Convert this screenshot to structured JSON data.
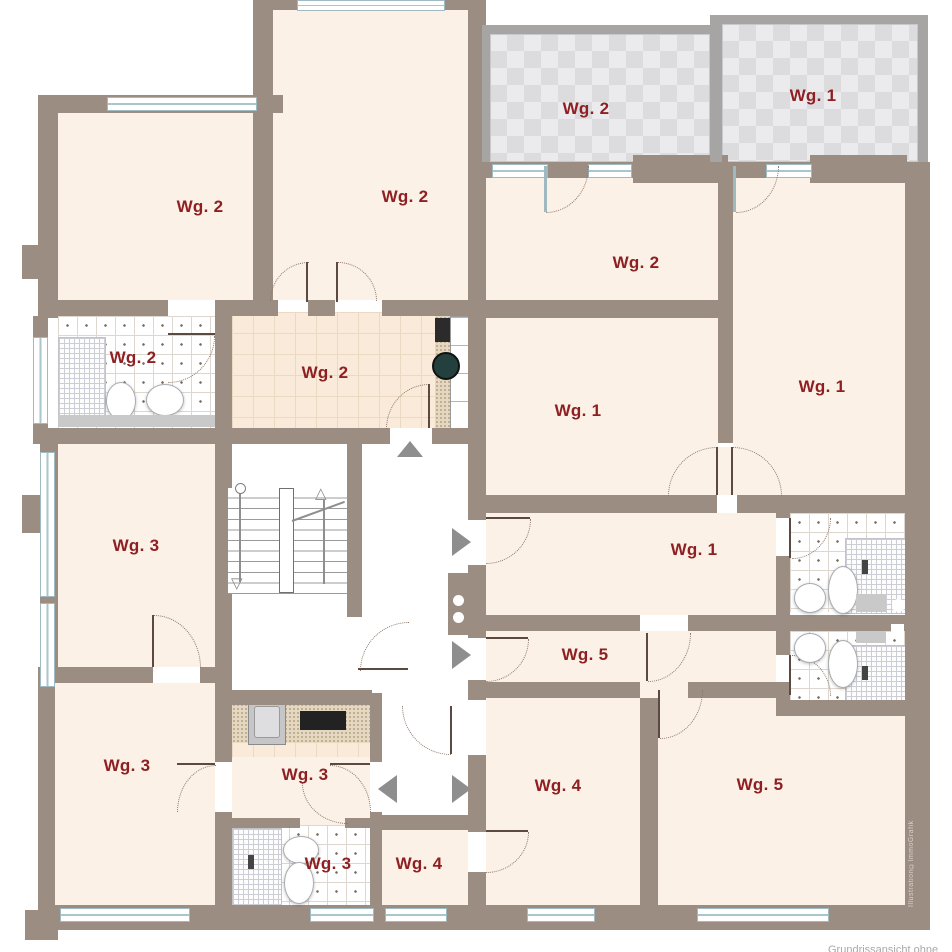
{
  "title": "Grundriss Mehrfamilienhaus (floor plan)",
  "colors": {
    "wall": "#9c8d83",
    "room": "#fcf1e6",
    "label": "#8e2023",
    "window": "#a9c6cd",
    "arrow": "#8e8e8e",
    "door": "#8b7668",
    "balcony_wall": "#a7a5a3",
    "gray_fixture": "#c9c9c9"
  },
  "labels": {
    "balcony_wg2": "Wg. 2",
    "balcony_wg1": "Wg. 1",
    "room_tl": "Wg. 2",
    "room_top": "Wg. 2",
    "room_tr": "Wg. 2",
    "room_right": "Wg. 1",
    "bath_wg2": "Wg. 2",
    "kitchen_wg2": "Wg. 2",
    "room_center": "Wg. 1",
    "hall_wg1": "Wg. 1",
    "room_wg3": "Wg. 3",
    "hall_wg5": "Wg. 5",
    "room_wg3_b": "Wg. 3",
    "hall_wg3": "Wg. 3",
    "bath_wg3": "Wg. 3",
    "entry_wg4": "Wg. 4",
    "room_wg4": "Wg. 4",
    "room_wg5": "Wg. 5",
    "watermark": "Illustration©ImmoGrafik",
    "footer": "Grundrissansicht ohne Gewähr"
  }
}
